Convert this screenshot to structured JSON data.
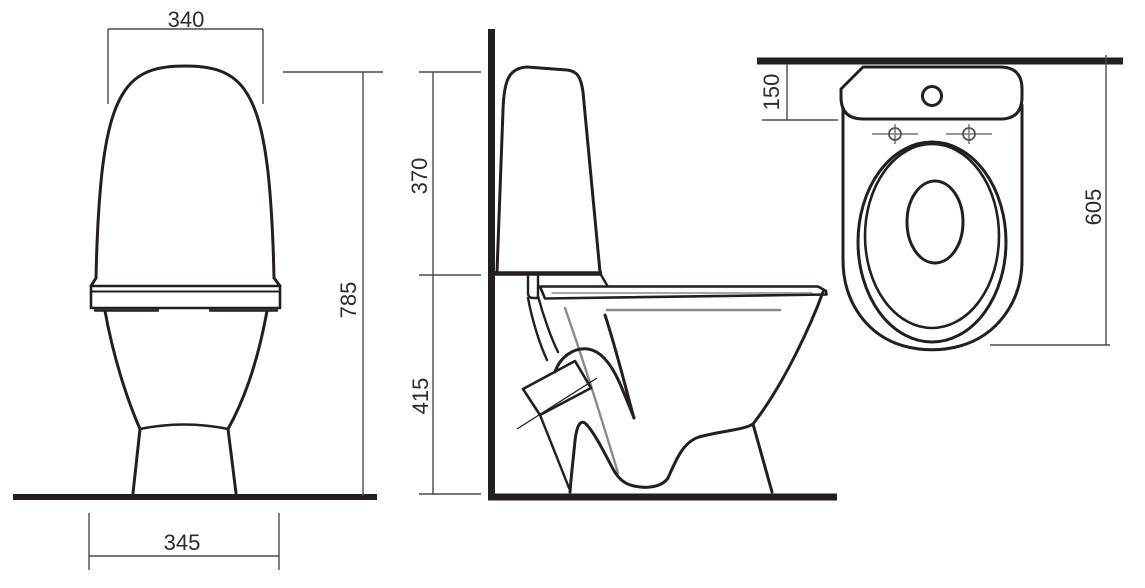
{
  "drawing": {
    "kind": "toilet-three-view-technical-drawing",
    "views": {
      "front": {
        "dims": {
          "tank_width": "340",
          "total_height": "785",
          "base_width": "345"
        }
      },
      "side": {
        "dims": {
          "tank_section_height": "370",
          "bowl_section_height": "415"
        }
      },
      "top": {
        "dims": {
          "wall_to_tank_front": "150",
          "total_depth": "605"
        }
      }
    },
    "colors": {
      "outline": "#231f20",
      "thin_gray": "#8a8a8a",
      "dimension_line": "#4a4a4a",
      "background": "#ffffff"
    }
  }
}
